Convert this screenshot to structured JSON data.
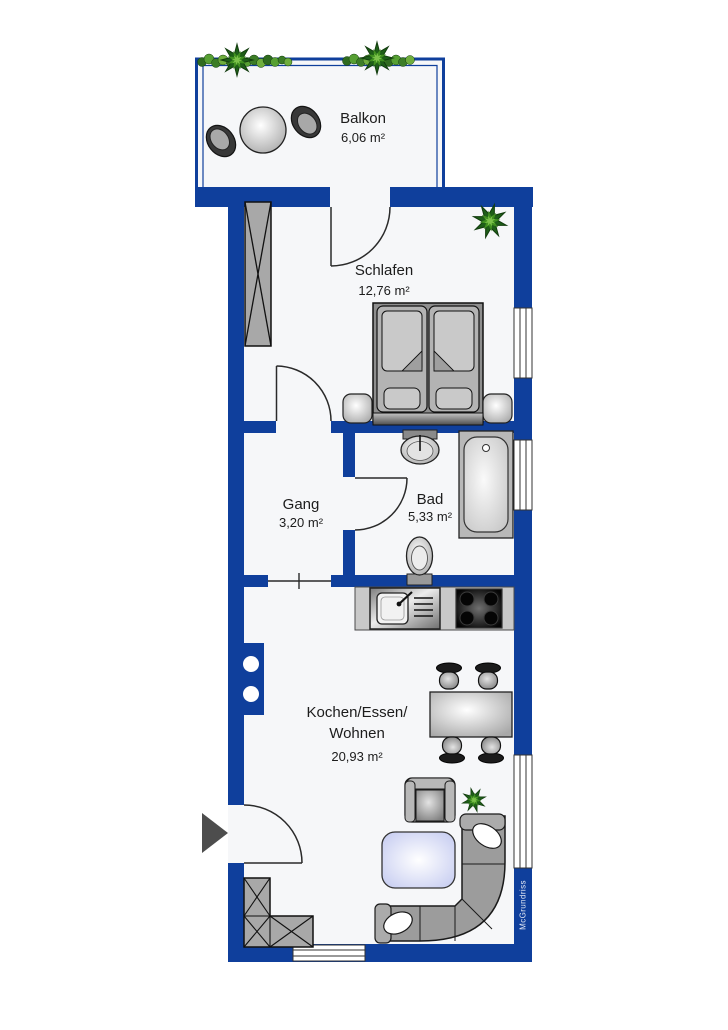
{
  "watermark": {
    "label": "McGrundriss"
  },
  "rooms": {
    "balkon": {
      "name": "Balkon",
      "area": "6,06 m²"
    },
    "schlafen": {
      "name": "Schlafen",
      "area": "12,76 m²"
    },
    "gang": {
      "name": "Gang",
      "area": "3,20 m²"
    },
    "bad": {
      "name": "Bad",
      "area": "5,33 m²"
    },
    "kochen": {
      "name_line1": "Kochen/Essen/",
      "name_line2": "Wohnen",
      "area": "20,93 m²"
    }
  },
  "colors": {
    "wall": "#0f3f9c",
    "floor": "#f6f7f9",
    "furniture_gray": "#a9a9a9",
    "coffee_table_blue": "#c9cef1",
    "plant_dark_green": "#1e5e18",
    "plant_light_green": "#4e9a2f",
    "pillow_white": "#ffffff"
  },
  "furniture": [
    "balcony-table",
    "balcony-chair",
    "plant-garland",
    "potted-plant",
    "wardrobe",
    "double-bed",
    "nightstand",
    "bathroom-sink",
    "bathtub",
    "toilet",
    "kitchen-counter",
    "kitchen-sink",
    "stove",
    "dining-table",
    "dining-chair",
    "armchair",
    "coffee-table",
    "corner-sofa",
    "entrance-arrow",
    "corner-wardrobe"
  ]
}
